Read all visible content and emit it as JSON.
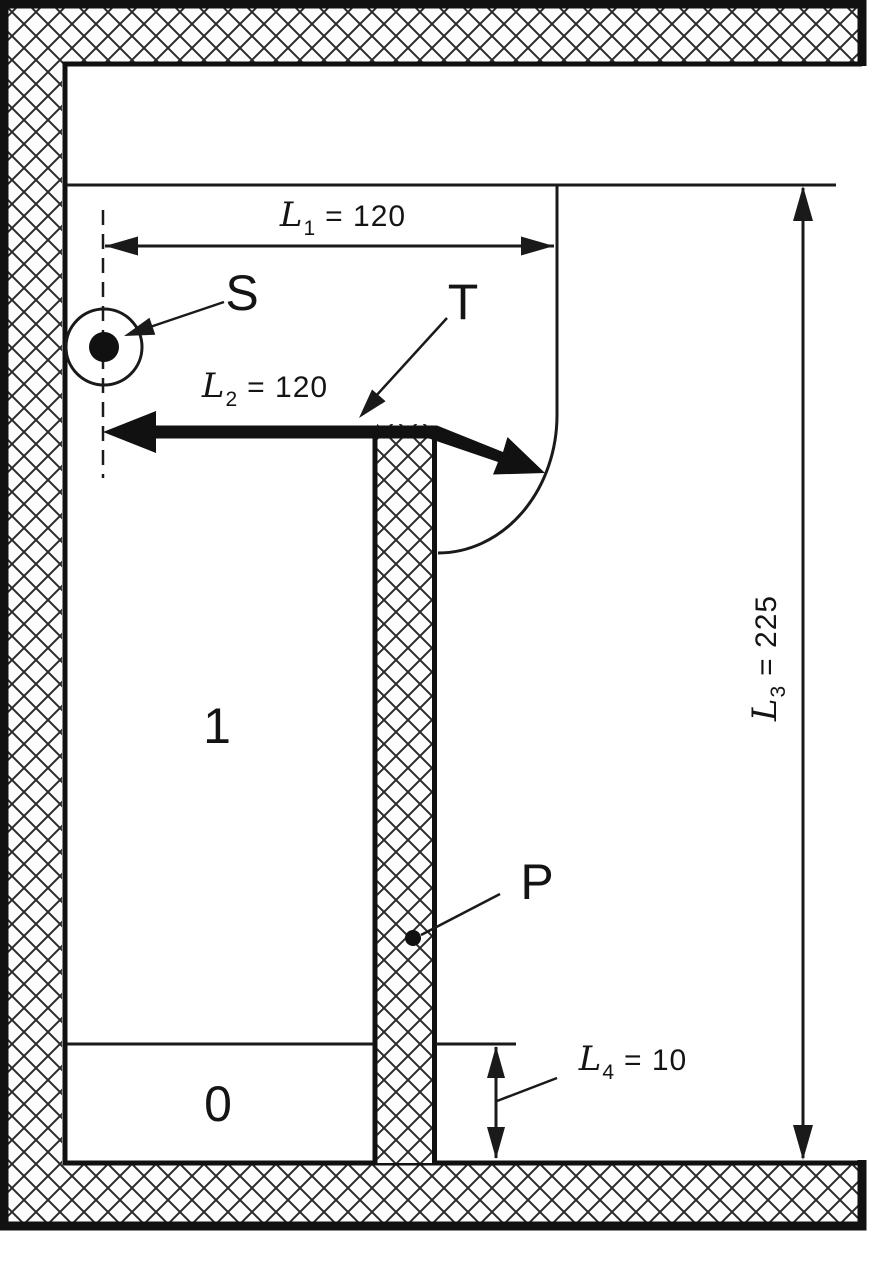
{
  "colors": {
    "ink": "#1a1a1a",
    "hatch_line": "#2b2b2b",
    "background": "#ffffff"
  },
  "diagram": {
    "region_labels": {
      "upper_chamber": "1",
      "lower_slit": "0"
    },
    "point_labels": {
      "source": "S",
      "transmission_path": "T",
      "partition": "P"
    },
    "dimensions": {
      "l1": {
        "symbol": "L",
        "sub": "1",
        "value": "= 120"
      },
      "l2": {
        "symbol": "L",
        "sub": "2",
        "value": "= 120"
      },
      "l3": {
        "symbol": "L",
        "sub": "3",
        "value": "= 225"
      },
      "l4": {
        "symbol": "L",
        "sub": "4",
        "value": "= 10"
      }
    }
  }
}
